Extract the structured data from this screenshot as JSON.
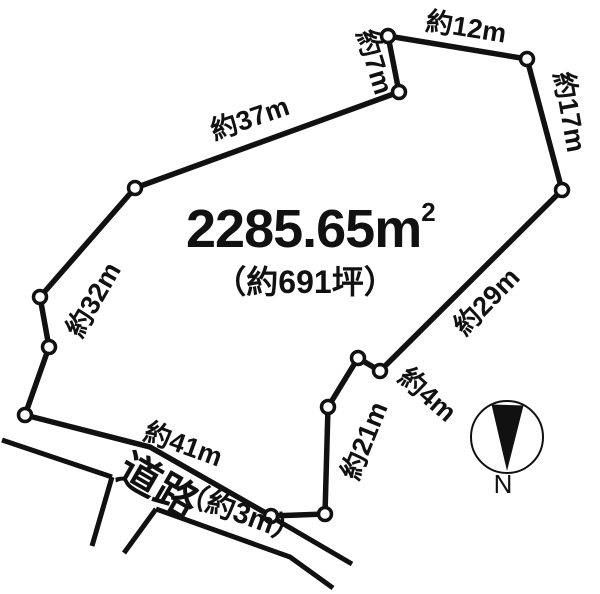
{
  "parcel": {
    "area_text": "2285.65m",
    "area_exponent": "2",
    "area_tsubo": "（約691坪）",
    "edge_labels": [
      {
        "name": "edge-37m",
        "label": "約37m"
      },
      {
        "name": "edge-7m",
        "label": "約7m"
      },
      {
        "name": "edge-12m",
        "label": "約12m"
      },
      {
        "name": "edge-17m",
        "label": "約17m"
      },
      {
        "name": "edge-29m",
        "label": "約29m"
      },
      {
        "name": "edge-4m",
        "label": "約4m"
      },
      {
        "name": "edge-21m",
        "label": "約21m"
      },
      {
        "name": "edge-32m",
        "label": "約32m"
      },
      {
        "name": "edge-41m",
        "label": "約41m"
      }
    ]
  },
  "road": {
    "label": "道路",
    "width_label": "（約3m）"
  },
  "compass": {
    "north_label": "N"
  },
  "colors": {
    "line": "#111111",
    "background": "#ffffff"
  }
}
